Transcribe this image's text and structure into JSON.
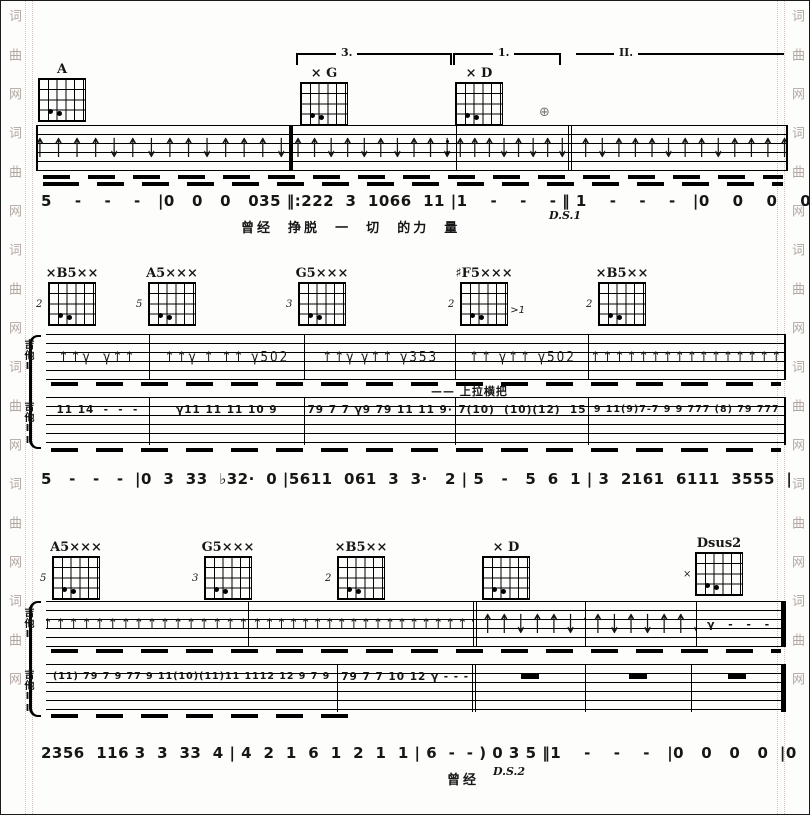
{
  "watermark": {
    "column_text": "词曲网词曲网词曲网词曲网词曲网词曲网"
  },
  "labels": {
    "guitar1": "吉他I",
    "guitar2": "吉他II"
  },
  "section1": {
    "voltas": [
      "3.",
      "1.",
      "II."
    ],
    "coda_mark": "⊕",
    "chords": [
      {
        "label": "A",
        "fret": ""
      },
      {
        "label": "× G",
        "fret": ""
      },
      {
        "label": "× D",
        "fret": ""
      }
    ],
    "strums": [
      "↑↑↑↑↑↓↑↓↑↑↓↑↑↑↓↑",
      "↑↑↑↓↑↓↑↓↑↑↓↑",
      "↑↑↑↑↓↑↓↑↓↑",
      "↑↑↑↓↑↑↑↓↑↑↓↑↑↑↑↓"
    ],
    "jianpu": "5    -    -    -   |0   0   0   035 ‖:222  3  1066  11 |1    -    -    - ‖ 1    -    -    -   |0    0    0    0  |",
    "lyrics": "曾经  挣脱  一  切  的力  量",
    "ds": "D.S.1"
  },
  "section2": {
    "chords": [
      {
        "label": "×B5××",
        "fret": "2",
        "note": ""
      },
      {
        "label": "A5×××",
        "fret": "5",
        "note": ""
      },
      {
        "label": "G5×××",
        "fret": "3",
        "note": ""
      },
      {
        "label": "♯F5×××",
        "fret": "2",
        "note": ">1"
      },
      {
        "label": "×B5××",
        "fret": "2",
        "note": ""
      }
    ],
    "guitar1": [
      "↑↑γ  γ↑↑",
      "↑↑γ ↑ ↑↑ γ502",
      "↑↑γ γ↑↑ γ353",
      "↑↑ γ↑↑ γ502",
      "↑↑↑↑↑↑↑↑↑↑↑↑↑↑↑↑"
    ],
    "guitar2": [
      "11 14  -  -  -",
      "γ11 11 11 10 9",
      "79 7 7 γ9 79 11 11 9·",
      "7(10)  (10)(12)  15",
      "9 11(9)7-7 9 9 777 (8) 79 777"
    ],
    "annotation": "—— 上拉横把",
    "jianpu": "5   -   -   -  |0  3  33  ♭32·  0 |5611  061  3  3·   2 | 5   -   5  6  1 | 3  2161  6111  3555  |"
  },
  "section3": {
    "chords": [
      {
        "label": "A5×××",
        "fret": "5"
      },
      {
        "label": "G5×××",
        "fret": "3"
      },
      {
        "label": "×B5××",
        "fret": "2"
      },
      {
        "label": "× D",
        "fret": ""
      },
      {
        "label": "Dsus2",
        "fret": "×"
      }
    ],
    "guitar1": [
      "↑↑↑↑↑↑↑↑↑↑↑↑↑↑↑↑",
      "↑↑↑↑↑↑↑↑↑↑↑↑↑↑↑↑↑↑↑↑",
      "↑↑↑↓↑↑↓↑",
      "↑↑↓↑↓↑↑↓",
      "γ  -  -  -"
    ],
    "guitar2": [
      "(11) 79 7 9 77 9 11(10)(11)11 1112 12 9 7 9",
      "79 7 7 10 12 γ - - -",
      "",
      "",
      ""
    ],
    "jianpu": "2356  116 3  3  33  4 | 4  2  1  6  1  2  1  1 | 6  -  - ) 0 3 5 ‖1    -    -    -   |0   0   0   0  |0  0  0  0 ‖",
    "lyrics": "曾经",
    "ds": "D.S.2"
  }
}
